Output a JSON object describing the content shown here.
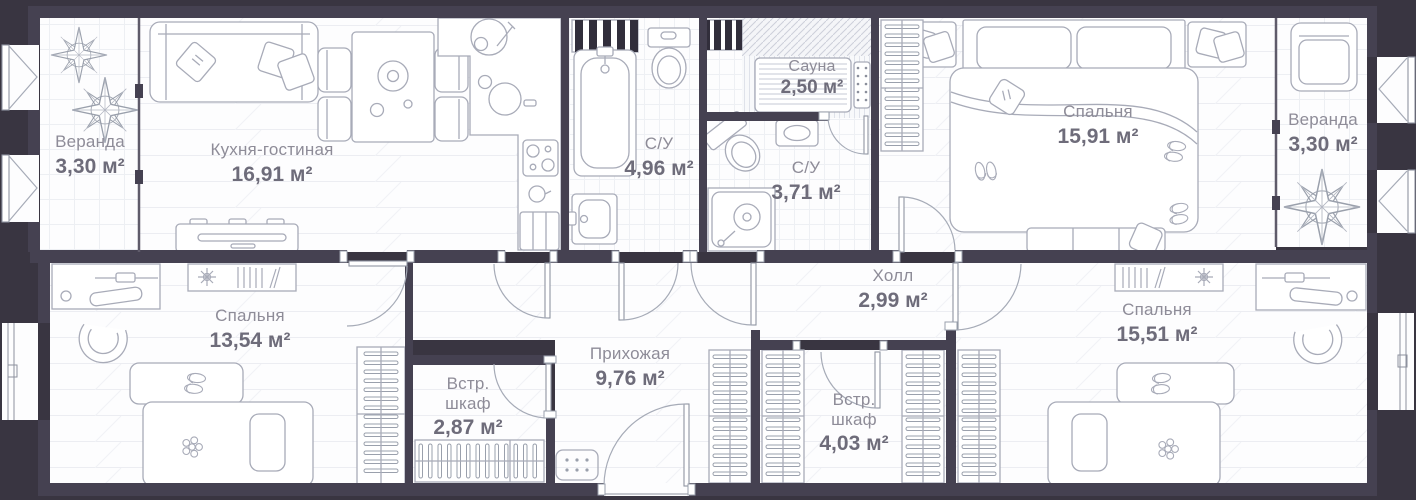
{
  "plan": {
    "area_unit": "м²",
    "rooms": [
      {
        "id": "veranda-left",
        "name": "Веранда",
        "area": "3,30 м²"
      },
      {
        "id": "kitchen-living",
        "name": "Кухня-гостиная",
        "area": "16,91 м²"
      },
      {
        "id": "bathroom-1",
        "name": "С/У",
        "area": "4,96 м²"
      },
      {
        "id": "sauna",
        "name": "Сауна",
        "area": "2,50 м²"
      },
      {
        "id": "bathroom-2",
        "name": "С/У",
        "area": "3,71 м²"
      },
      {
        "id": "bedroom-1",
        "name": "Спальня",
        "area": "15,91 м²"
      },
      {
        "id": "veranda-right",
        "name": "Веранда",
        "area": "3,30 м²"
      },
      {
        "id": "bedroom-2",
        "name": "Спальня",
        "area": "13,54 м²"
      },
      {
        "id": "closet-1",
        "name": "Встр. шкаф",
        "area": "2,87 м²"
      },
      {
        "id": "hallway",
        "name": "Прихожая",
        "area": "9,76 м²"
      },
      {
        "id": "hall",
        "name": "Холл",
        "area": "2,99 м²"
      },
      {
        "id": "closet-2",
        "name": "Встр. шкаф",
        "area": "4,03 м²"
      },
      {
        "id": "bedroom-3",
        "name": "Спальня",
        "area": "15,51 м²"
      }
    ],
    "colors": {
      "background": "#393541",
      "wall": "#454151",
      "floor": "#fdfdfe",
      "floor_lines": "#ecedf2",
      "furniture_outline": "#a8abb8",
      "room_name_text": "#8e8c98",
      "room_area_text": "#6e6c7a",
      "dark_units": "#312e3b"
    },
    "furniture_icons": [
      "compass-rose-icon",
      "sofa-icon",
      "dining-table-icon",
      "chair-icon",
      "kitchen-counter-icon",
      "sink-icon",
      "cooktop-icon",
      "cutting-board-icon",
      "fridge-icon",
      "tv-stand-icon",
      "laundry-unit-icon",
      "bathtub-icon",
      "toilet-icon",
      "washbasin-icon",
      "sauna-bench-icon",
      "sauna-heater-icon",
      "shower-icon",
      "double-bed-icon",
      "nightstand-icon",
      "bedside-bench-icon",
      "wardrobe-rack-icon",
      "armchair-icon",
      "desk-icon",
      "office-chair-icon",
      "bookshelf-icon",
      "single-bed-icon",
      "slippers-icon",
      "plant-icon",
      "doormat-icon",
      "door-swing-icon",
      "window-icon"
    ]
  }
}
